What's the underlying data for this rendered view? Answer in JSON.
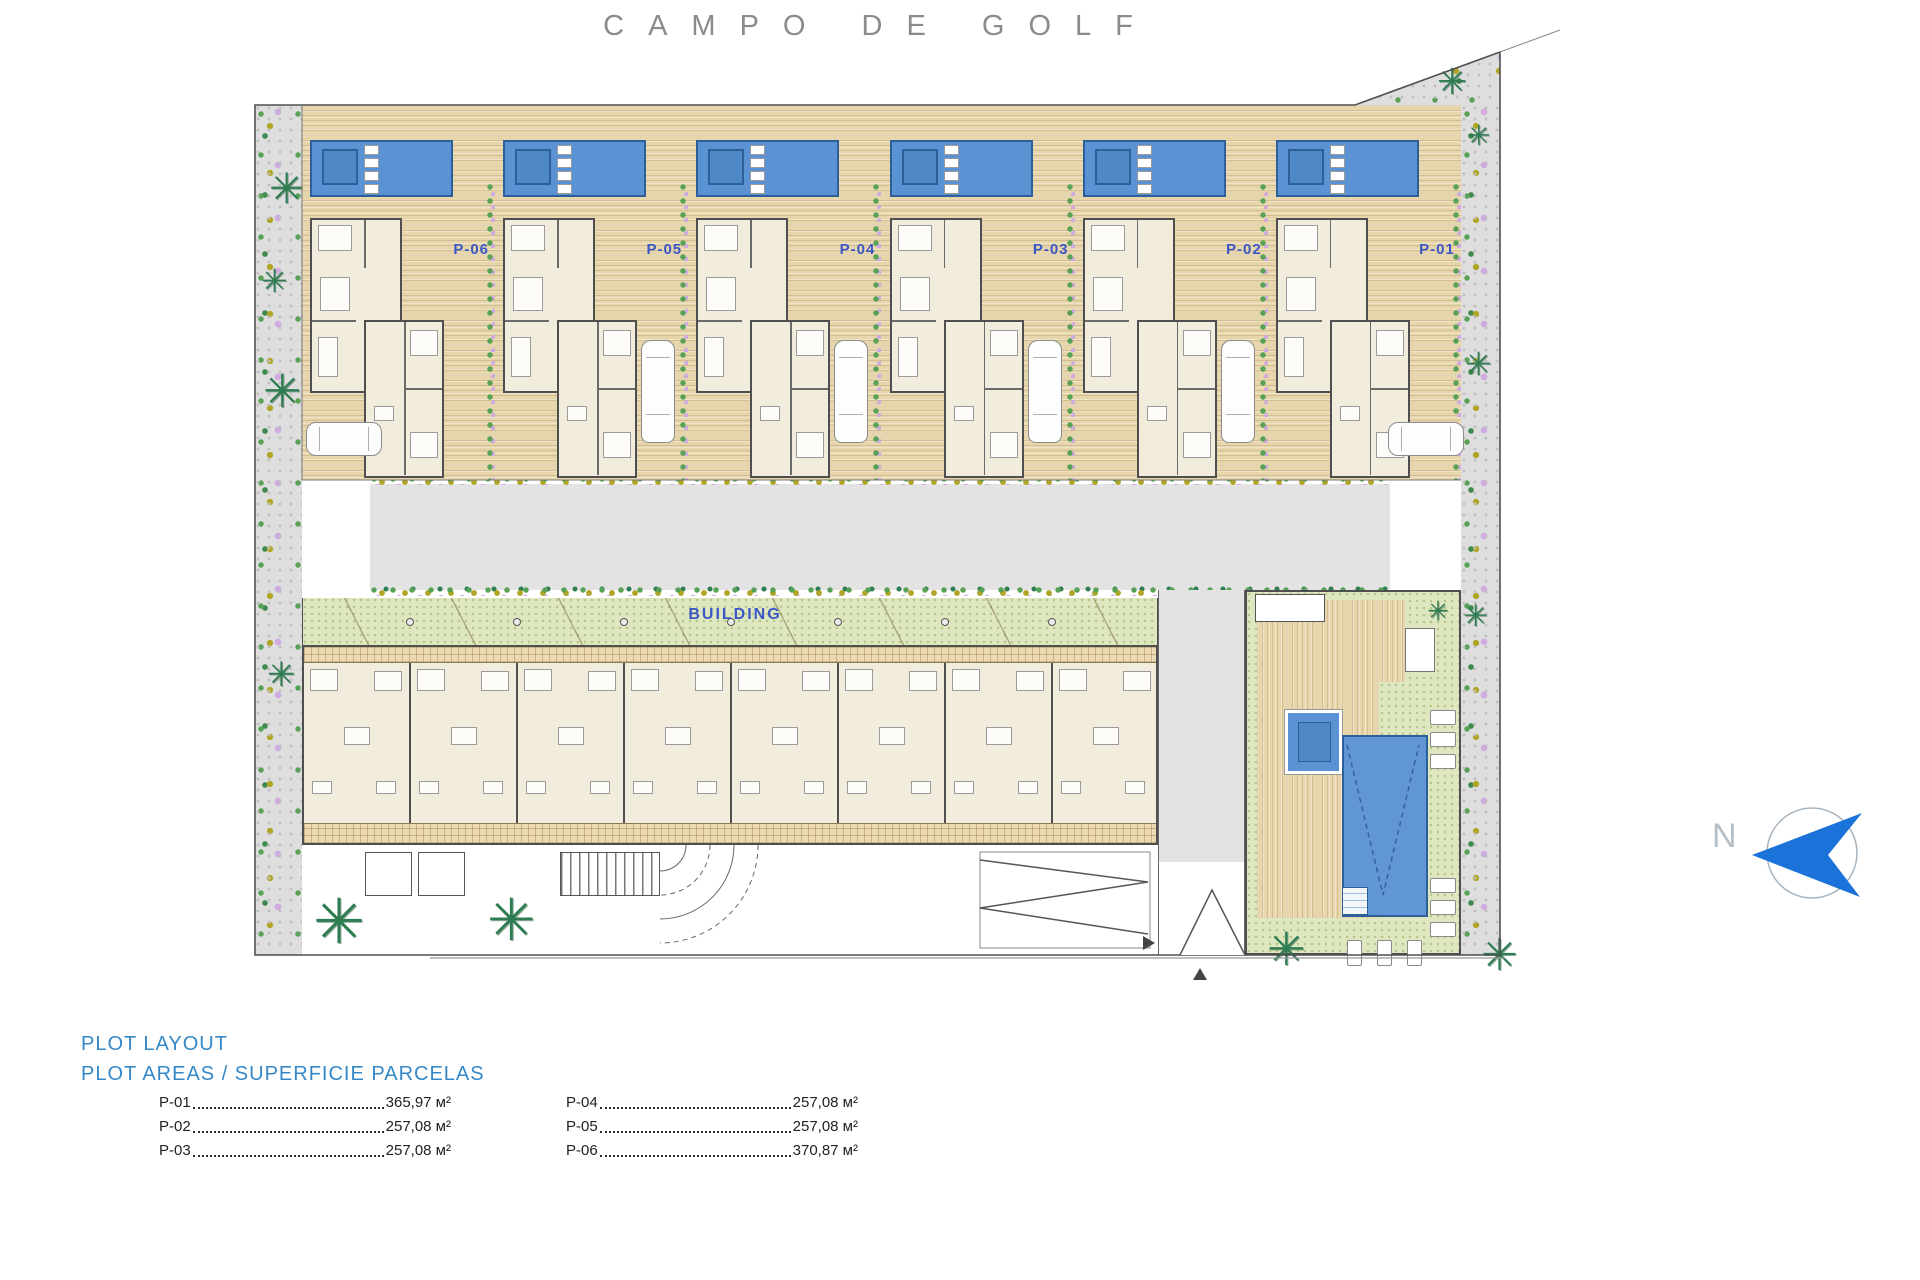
{
  "title": "CAMPO DE GOLF",
  "plan": {
    "building_label": "BUILDING",
    "north_label": "N",
    "plots": [
      {
        "id": "P-06"
      },
      {
        "id": "P-05"
      },
      {
        "id": "P-04"
      },
      {
        "id": "P-03"
      },
      {
        "id": "P-02"
      },
      {
        "id": "P-01"
      }
    ]
  },
  "legend": {
    "title": "PLOT LAYOUT",
    "subtitle": "PLOT AREAS / SUPERFICIE PARCELAS",
    "columns": [
      [
        {
          "plot": "P-01",
          "area": "365,97 м²"
        },
        {
          "plot": "P-02",
          "area": "257,08 м²"
        },
        {
          "plot": "P-03",
          "area": "257,08 м²"
        }
      ],
      [
        {
          "plot": "P-04",
          "area": "257,08 м²"
        },
        {
          "plot": "P-05",
          "area": "257,08 м²"
        },
        {
          "plot": "P-06",
          "area": "370,87 м²"
        }
      ]
    ]
  },
  "icons": {
    "palm": "✳"
  },
  "colors": {
    "accent_blue": "#3b57c4",
    "legend_blue": "#3488c8",
    "pool_blue": "#5b92d4",
    "north_blue": "#1b72d8",
    "title_gray": "#8b8b8b"
  }
}
